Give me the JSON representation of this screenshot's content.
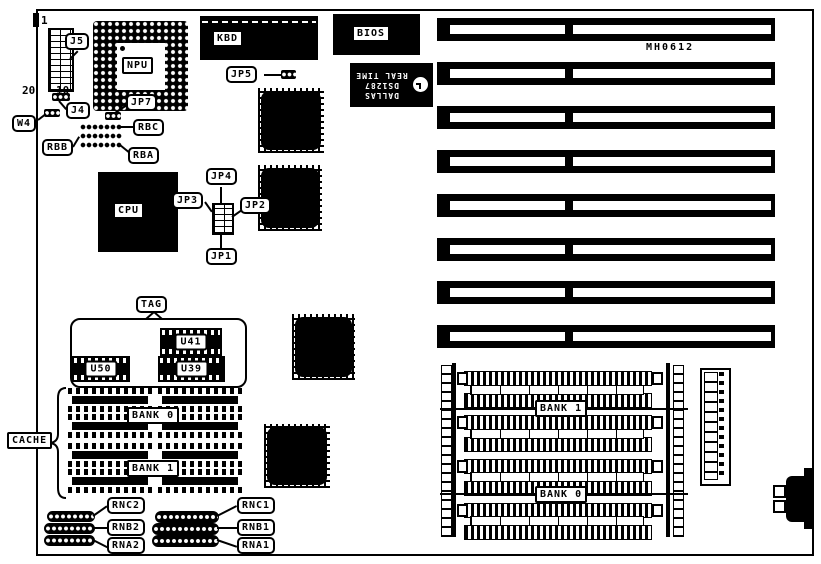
{
  "board": {
    "model": "MH0612",
    "components": {
      "j5": {
        "label": "J5",
        "pin1": "1",
        "pin10": "10",
        "pin20": "20"
      },
      "j4": "J4",
      "w4": "W4",
      "jp7": "JP7",
      "npu": "NPU",
      "rbc": "RBC",
      "rbb": "RBB",
      "rba": "RBA",
      "cpu": "CPU",
      "jp1": "JP1",
      "jp2": "JP2",
      "jp3": "JP3",
      "jp4": "JP4",
      "jp5": "JP5",
      "kbd": "KBD",
      "bios": "BIOS",
      "rtc": {
        "line1": "DALLAS",
        "line2": "DS1287",
        "line3": "REAL TIME"
      },
      "tag": "TAG",
      "u41": "U41",
      "u50": "U50",
      "u39": "U39",
      "cache": {
        "label": "CACHE",
        "bank0": "BANK 0",
        "bank1": "BANK 1"
      },
      "simm": {
        "bank1": "BANK 1",
        "bank0": "BANK 0"
      },
      "networks": {
        "rnc2": "RNC2",
        "rnb2": "RNB2",
        "rna2": "RNA2",
        "rnc1": "RNC1",
        "rnb1": "RNB1",
        "rna1": "RNA1"
      }
    }
  }
}
